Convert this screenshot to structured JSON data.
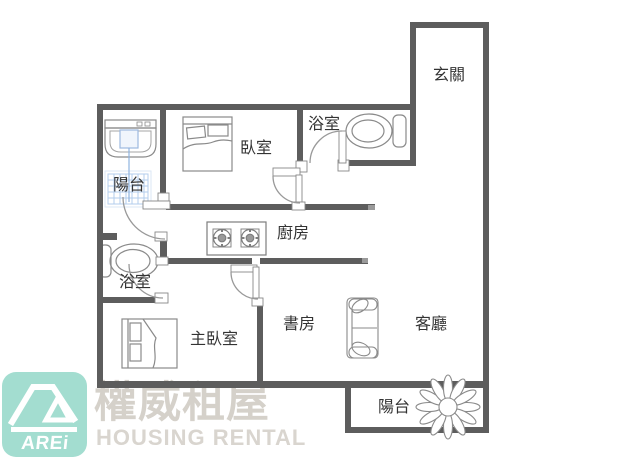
{
  "page": {
    "type": "floor-plan",
    "background": "#ffffff"
  },
  "floor_plan": {
    "rooms": {
      "entry": "玄關",
      "bedroom": "臥室",
      "bathroom_top": "浴室",
      "balcony_laundry": "陽台",
      "kitchen": "廚房",
      "bathroom_lower": "浴室",
      "master_bedroom": "主臥室",
      "study": "書房",
      "living_room": "客廳",
      "balcony_rear": "陽台"
    }
  },
  "branding": {
    "logo_text": "AREi",
    "watermark_cn": "權威租屋",
    "watermark_en": "HOUSING RENTAL"
  },
  "colors": {
    "wall": "#5d5d5d",
    "fixture_line": "#8a8a8a",
    "door_arc": "#999999",
    "tile_blue": "#b3cdec",
    "water_blue": "#8fb3e0",
    "logo_bg": "#a3ddd0",
    "logo_fg": "#ffffff",
    "watermark": "#d5d1ca",
    "label_text": "#333333"
  }
}
